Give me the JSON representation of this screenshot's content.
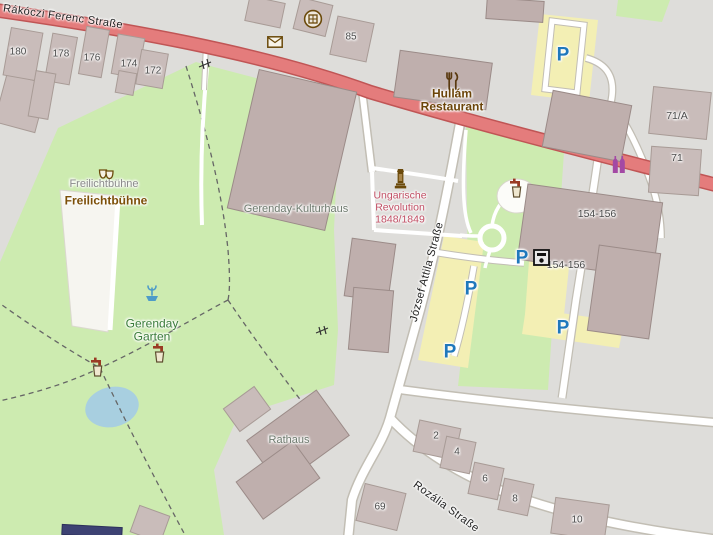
{
  "map": {
    "streets": {
      "rakoczi": "Rákóczi Ferenc Straße",
      "jozsef_attila": "József Attila  Straße",
      "rozalia": "Rozália Straße"
    },
    "pois": {
      "hullam_restaurant": "Hullám\nRestaurant",
      "freilichtbuehne_poi": "Freilichtbühne",
      "freilichtbuehne_area": "Freilichtbühne",
      "gerenday_kulturhaus": "Gerenday-Kulturhaus",
      "ungarische_revolution": "Ungarische\nRevolution\n1848/1849",
      "gerenday_garten": "Gerenday\nGarten",
      "rathaus": "Rathaus",
      "building_154_156": "154-156",
      "atm_154_156": "154-156",
      "building_71a": "71/A",
      "building_71": "71"
    },
    "house_numbers": [
      "180",
      "178",
      "176",
      "174",
      "172",
      "85",
      "69",
      "2",
      "4",
      "6",
      "8",
      "10"
    ],
    "parking_symbol": "P",
    "icons": [
      "postbox-icon",
      "artwork-icon",
      "restaurant-icon",
      "theatre-icon",
      "memorial-icon",
      "fountain-icon",
      "drinking-water-icon",
      "atm-icon",
      "shop-icon",
      "gate-icon",
      "parking-symbol"
    ],
    "colors": {
      "primary_road": "#e47c7c",
      "park": "#cdebb0",
      "building": "#c9bcba",
      "parking_area": "#f3efb4",
      "water": "#a8cfe0",
      "parking_blue": "#1f78bc",
      "memorial_label": "#c14e64"
    }
  }
}
